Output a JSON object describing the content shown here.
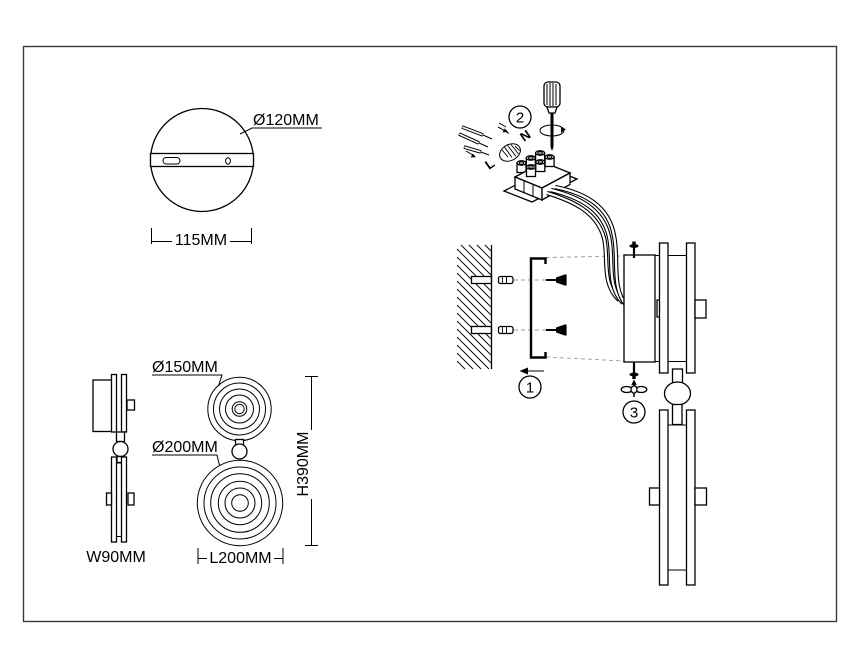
{
  "drawing": {
    "background": "#ffffff",
    "line_color": "#000000",
    "guide_color": "#9a9a9a",
    "description_labels": {
      "type": "lamp installation technical drawing"
    }
  },
  "top_view": {
    "diameter_label": "Ø120MM",
    "width_label": "115MM"
  },
  "side_view": {
    "width_label": "W90MM"
  },
  "front_view": {
    "upper_disc_label": "Ø150MM",
    "lower_disc_label": "Ø200MM",
    "length_label": "L200MM",
    "height_label": "H390MM"
  },
  "assembly": {
    "step1": "1",
    "step2": "2",
    "step3": "3",
    "live": "L",
    "neutral": "N"
  }
}
